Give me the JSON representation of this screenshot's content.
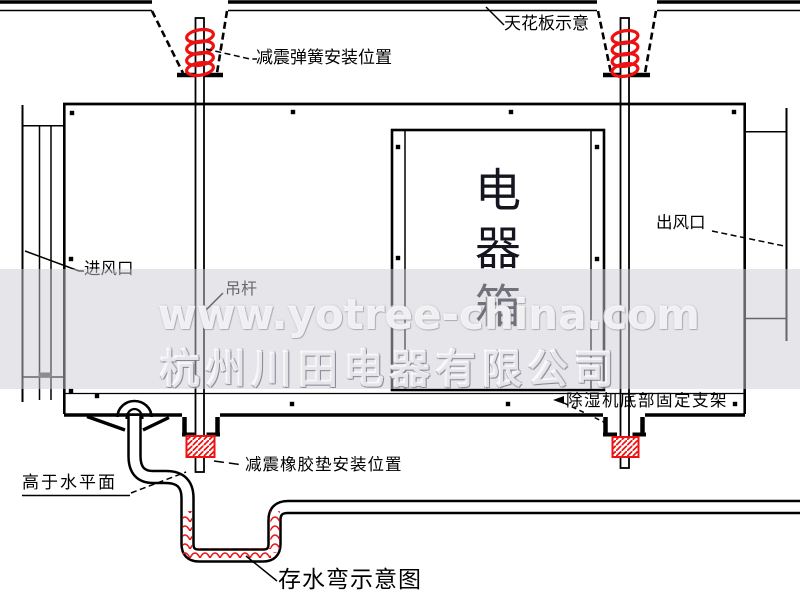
{
  "watermark": {
    "line1": "www.yotree-china.com",
    "line2": "杭州川田电器有限公司"
  },
  "unit": {
    "electrical_box": "电器箱"
  },
  "labels": {
    "spring": "减震弹簧安装位置",
    "ceiling": "天花板示意",
    "outlet": "出风口",
    "inlet": "进风口",
    "hanger_rod": "吊杆",
    "bottom_bracket": "除湿机底部固定支架",
    "rubber_pad": "减震橡胶垫安装位置",
    "above_water": "高于水平面",
    "water_trap": "存水弯示意图"
  },
  "colors": {
    "line": "#000000",
    "accent_red": "#ee1111",
    "watermark_band": "rgba(205,205,214,0.5)",
    "damper_gray": "#4a4a4a"
  }
}
